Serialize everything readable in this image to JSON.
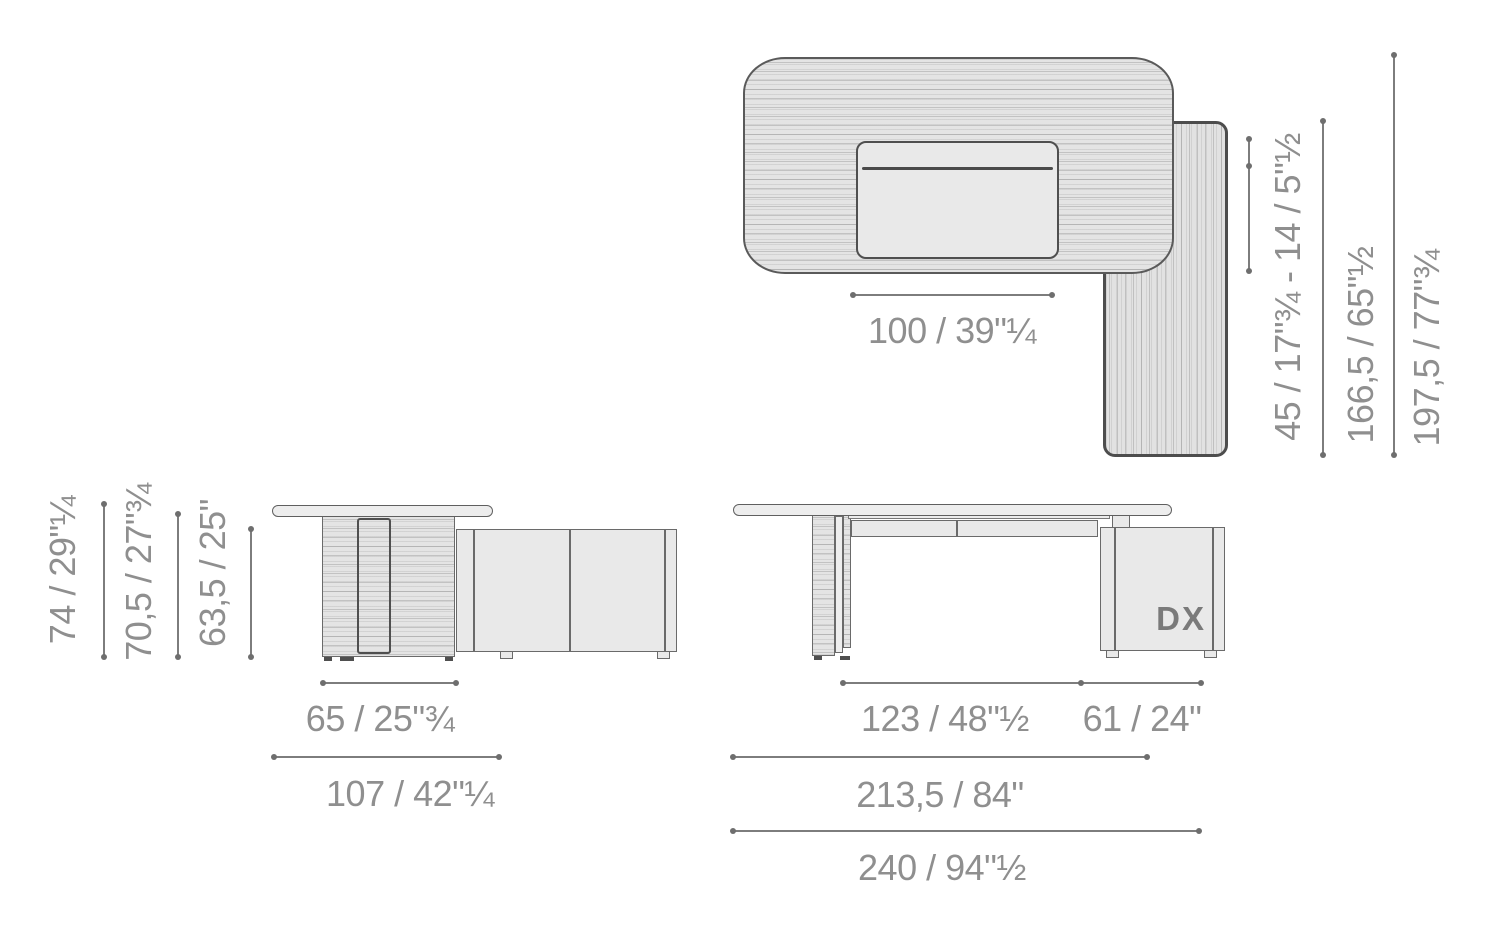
{
  "colors": {
    "outline": "#5a5a5a",
    "outline_heavy": "#4d4d4d",
    "fill_light": "#e9e9e9",
    "dim_text": "#8f8f8f",
    "dim_line": "#7d7d7d"
  },
  "plan": {
    "dim_width": "100 / 39\"¼",
    "dim_overhang_range": "45 / 17\"¾ - 14 / 5\"½",
    "dim_return_depth": "166,5 / 65\"½",
    "dim_total_depth": "197,5 / 77\"¾"
  },
  "side": {
    "dim_height_total": "74 / 29\"¼",
    "dim_height_worktop": "70,5 / 27\"¾",
    "dim_height_credenza": "63,5 / 25\"",
    "dim_leg_depth": "65 / 25\"¾",
    "dim_total_depth": "107 / 42\"¼"
  },
  "front": {
    "cabinet_label": "DX",
    "dim_desk_span": "123 / 48\"½",
    "dim_cabinet_span": "61 / 24\"",
    "dim_top_width": "213,5 / 84\"",
    "dim_total_width": "240 / 94\"½"
  }
}
